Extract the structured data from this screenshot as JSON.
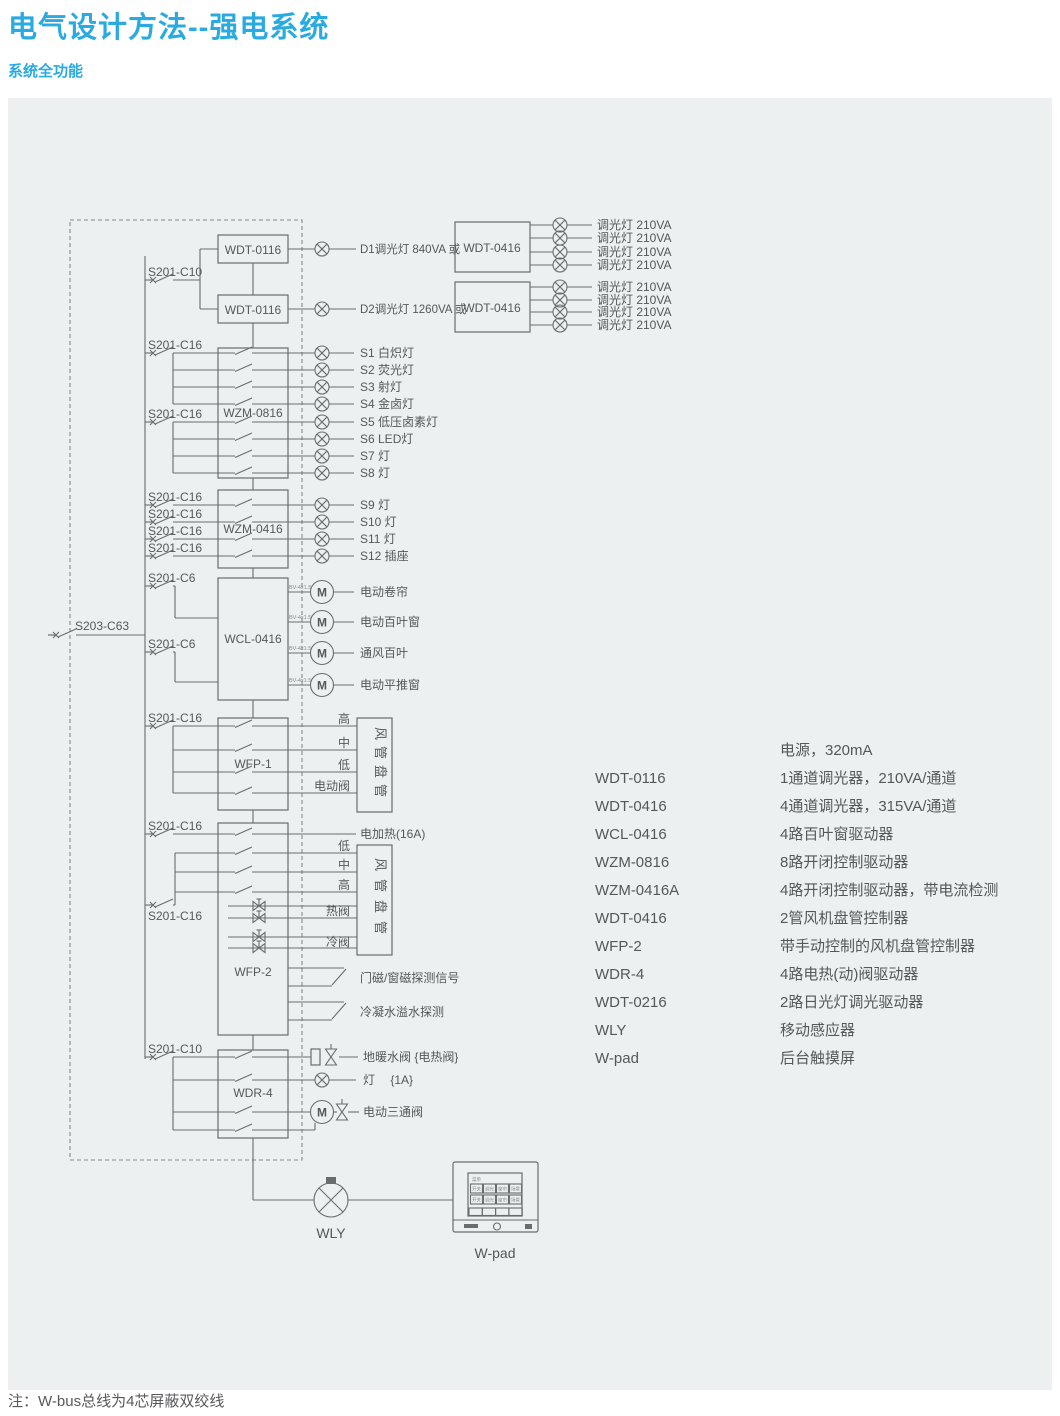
{
  "colors": {
    "accent": "#29abe2",
    "panel": "#edf0f1",
    "line": "#6a6c6e",
    "text": "#55575a"
  },
  "header": {
    "title": "电气设计方法--强电系统",
    "subtitle": "系统全功能"
  },
  "footnote": "注：W-bus总线为4芯屏蔽双绞线",
  "diagram": {
    "main_breaker": "S203-C63",
    "breaker_c10": "S201-C10",
    "breaker_c16": "S201-C16",
    "breaker_c6": "S201-C6",
    "motor_m": "M",
    "wire_spec": "BV-4x1.5",
    "modules": {
      "wdt0116": "WDT-0116",
      "wdt0416": "WDT-0416",
      "wzm0816": "WZM-0816",
      "wzm0416": "WZM-0416",
      "wcl0416": "WCL-0416",
      "wfp1": "WFP-1",
      "wfp2": "WFP-2",
      "wdr4": "WDR-4"
    },
    "dimmers": {
      "d1": "D1调光灯 840VA 或",
      "d2": "D2调光灯 1260VA 或",
      "channel": "调光灯 210VA"
    },
    "lights": [
      "S1 白炽灯",
      "S2 荧光灯",
      "S3 射灯",
      "S4 金卤灯",
      "S5 低压卤素灯",
      "S6 LED灯",
      "S7 灯",
      "S8 灯"
    ],
    "zones": [
      "S9  灯",
      "S10 灯",
      "S11 灯",
      "S12 插座"
    ],
    "motors": [
      "电动卷帘",
      "电动百叶窗",
      "通风百叶",
      "电动平推窗"
    ],
    "fan_coil": "风管盘管",
    "wfp1_rows": [
      "高",
      "中",
      "低",
      "电动阀"
    ],
    "wfp2_rows": {
      "heater": "电加热(16A)",
      "low": "低",
      "mid": "中",
      "high": "高",
      "hot_valve": "热阀",
      "cold_valve": "冷阀",
      "door": "门磁/窗磁探测信号",
      "condensate": "冷凝水溢水探测"
    },
    "wdr4_rows": {
      "floor_valve": "地暖水阀 {电热阀}",
      "lamp": "灯　 {1A}",
      "three_way": "电动三通阀"
    },
    "wly": "WLY",
    "wpad": "W-pad",
    "wpad_screen": {
      "menu": "菜单",
      "b1": "开关",
      "b2": "调光",
      "b3": "窗帘",
      "b4": "场景"
    }
  },
  "legend": {
    "rows": [
      {
        "code": "",
        "desc": "电源，320mA"
      },
      {
        "code": "WDT-0116",
        "desc": "1通道调光器，210VA/通道"
      },
      {
        "code": "WDT-0416",
        "desc": "4通道调光器，315VA/通道"
      },
      {
        "code": "WCL-0416",
        "desc": "4路百叶窗驱动器"
      },
      {
        "code": "WZM-0816",
        "desc": "8路开闭控制驱动器"
      },
      {
        "code": "WZM-0416A",
        "desc": "4路开闭控制驱动器，带电流检测"
      },
      {
        "code": "WDT-0416",
        "desc": "2管风机盘管控制器"
      },
      {
        "code": "WFP-2",
        "desc": "带手动控制的风机盘管控制器"
      },
      {
        "code": "WDR-4",
        "desc": "4路电热(动)阀驱动器"
      },
      {
        "code": "WDT-0216",
        "desc": "2路日光灯调光驱动器"
      },
      {
        "code": "WLY",
        "desc": "移动感应器"
      },
      {
        "code": "W-pad",
        "desc": "后台触摸屏"
      }
    ]
  }
}
